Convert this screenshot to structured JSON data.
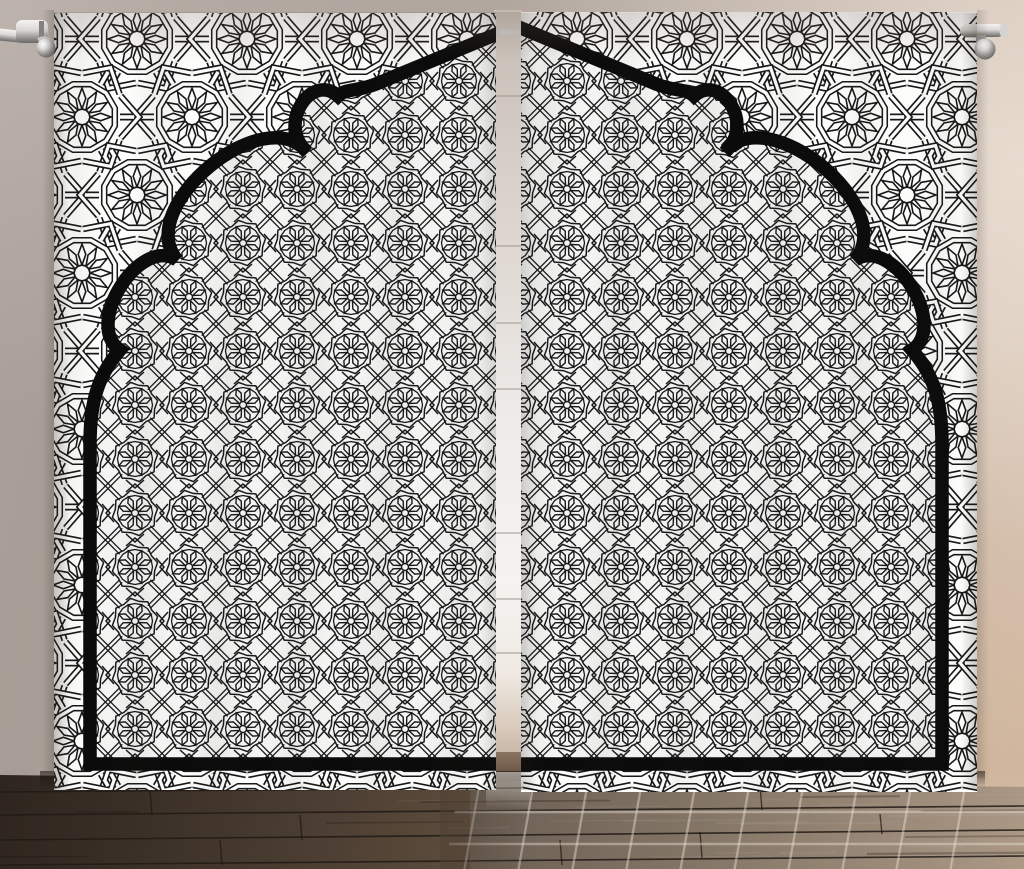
{
  "scene": {
    "description": "Product photo of a two-panel room curtain printed with a black and white Arabic geometric star pattern and a large Middle Eastern scalloped arch motif, hanging from a silver rod over a dark glossy hardwood floor",
    "elements": {
      "curtain_rod_left": "silver curtain rod end with chrome bracket, top left",
      "curtain_rod_right": "silver curtain rod end cap with chrome bracket, top right",
      "left_panel": "left curtain panel, white fabric with black geometric print",
      "right_panel": "right curtain panel, white fabric with black geometric print",
      "arch_motif": "thick black scalloped ogee arch frame printed across both panels",
      "outer_pattern": "large twelve-point star girih lattice outside the arch",
      "inner_pattern": "dense eight-petal rosette lattice inside the arch",
      "center_gap": "light wall and window light visible between the two panels",
      "floor": "dark hardwood planks with bright window reflection grid",
      "wall": "neutral taupe wall with warm light on the right side"
    }
  },
  "colors": {
    "pattern-ink": "#181818",
    "fabric-white": "#fcfcfb",
    "arch-black": "#0b0b0b",
    "wall-left": "#a89d96",
    "wall-top": "#c3b7ae",
    "wall-right": "#d8cabd",
    "wall-right-warm": "#c2a385",
    "gap-top": "#c6bbb3",
    "gap-light": "#f4f3f1",
    "floor-dark": "#362c24",
    "floor-mid": "#6b5a4b",
    "floor-warm": "#ab9278",
    "floor-reflection": "#aab2bc",
    "rod-silver": "#d9d7d4",
    "chrome-dark": "#4d4b49"
  }
}
